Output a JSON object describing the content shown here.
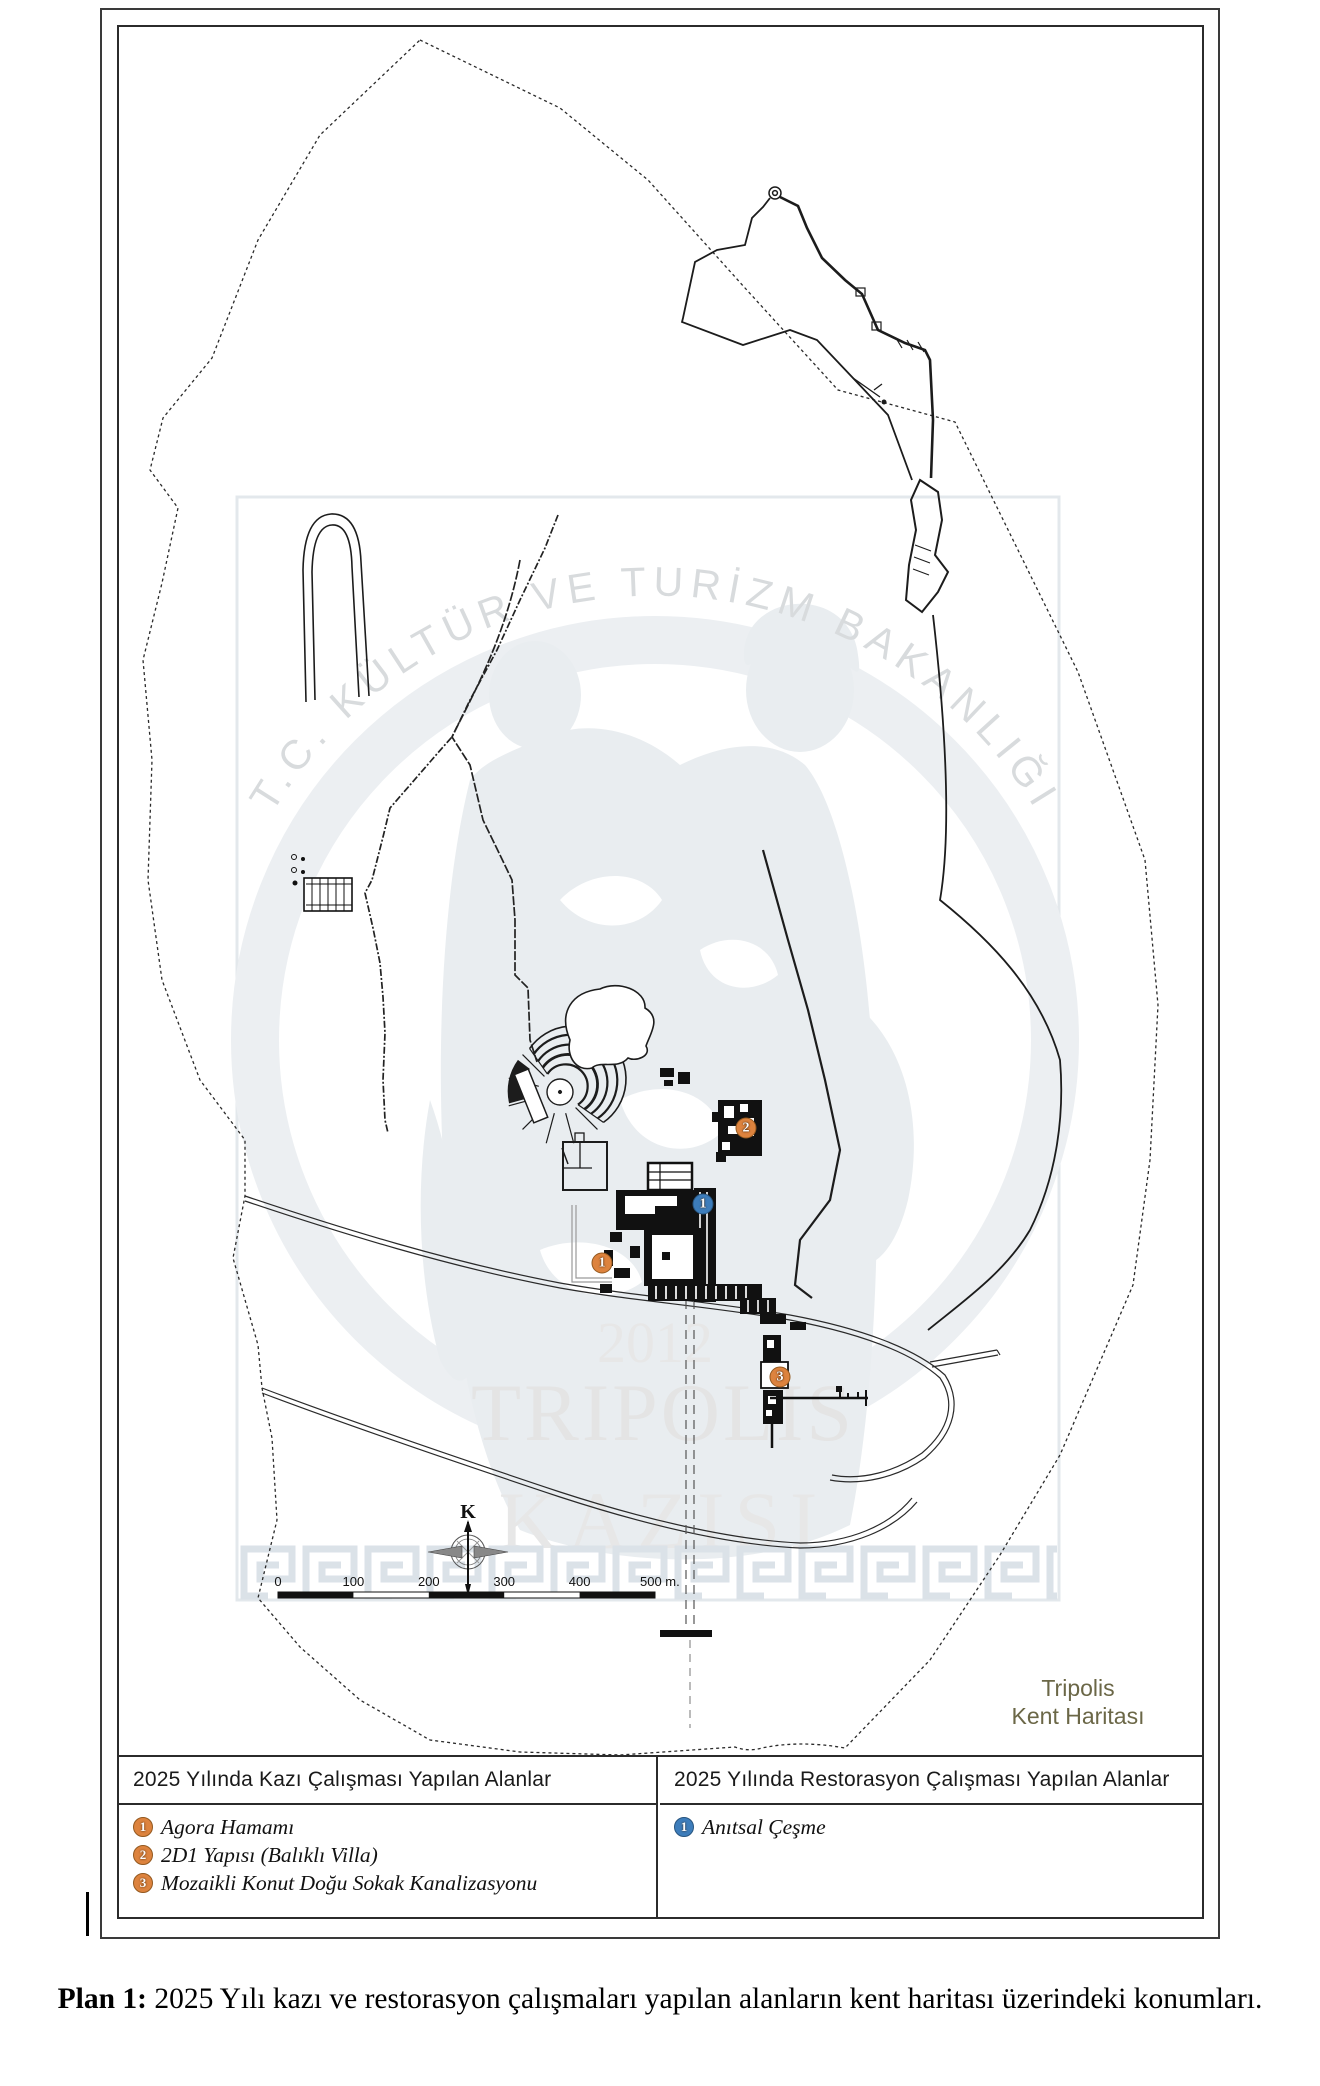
{
  "map": {
    "watermark": {
      "arc_text": "T.C. KÜLTÜR VE TURİZM BAKANLIĞI",
      "year": "2012",
      "title_line1": "TRIPOLIS",
      "title_line2": "KAZISI"
    },
    "map_label": {
      "line1": "Tripolis",
      "line2": "Kent Haritası",
      "color": "#6b6747"
    },
    "compass_label": "K",
    "scale_bar": {
      "ticks": [
        "0",
        "100",
        "200",
        "300",
        "400"
      ],
      "end_label": "500 m."
    },
    "marker_colors": {
      "excavation_fill": "#DD833E",
      "excavation_border": "#94591F",
      "restoration_fill": "#3D7DBB",
      "restoration_border": "#28557F"
    },
    "markers": {
      "excavation": [
        {
          "number": "1",
          "x": 602,
          "y": 1263
        },
        {
          "number": "2",
          "x": 746,
          "y": 1128
        },
        {
          "number": "3",
          "x": 780,
          "y": 1377
        }
      ],
      "restoration": [
        {
          "number": "1",
          "x": 703,
          "y": 1204
        }
      ]
    }
  },
  "legend": {
    "excavation": {
      "header": "2025 Yılında Kazı Çalışması Yapılan Alanlar",
      "items": [
        {
          "number": "1",
          "label": "Agora Hamamı"
        },
        {
          "number": "2",
          "label": "2D1 Yapısı (Balıklı Villa)"
        },
        {
          "number": "3",
          "label": "Mozaikli Konut Doğu Sokak Kanalizasyonu"
        }
      ]
    },
    "restoration": {
      "header": "2025 Yılında Restorasyon Çalışması Yapılan Alanlar",
      "items": [
        {
          "number": "1",
          "label": "Anıtsal Çeşme"
        }
      ]
    }
  },
  "caption": {
    "label": "Plan 1:",
    "text": " 2025 Yılı kazı ve restorasyon çalışmaları yapılan alanların kent haritası üzerindeki konumları."
  }
}
